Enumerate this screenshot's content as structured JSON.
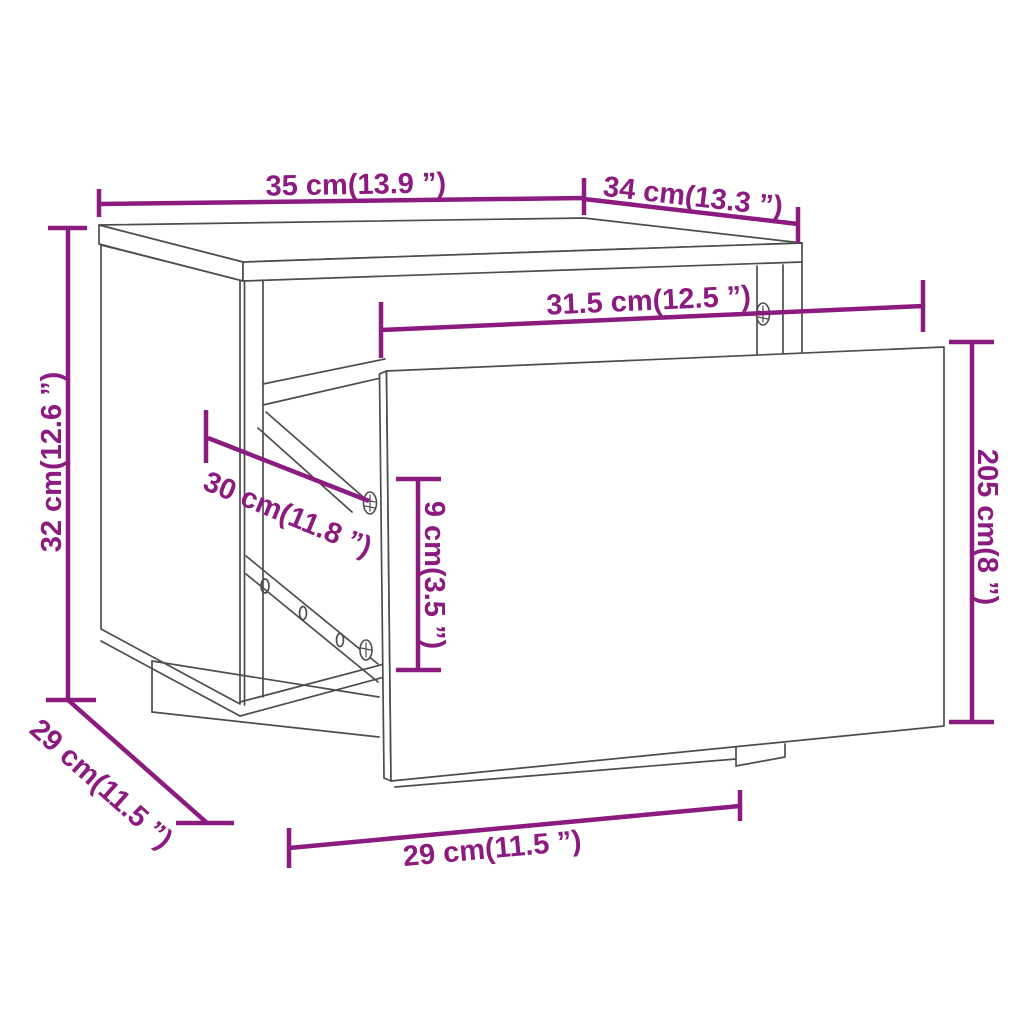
{
  "page": {
    "kind": "furniture-dimension-diagram",
    "product": "bedside cabinet with pulled-out drawer"
  },
  "style": {
    "dimension_color": "#8c1b80",
    "drawing_line_color": "#4d4d4d",
    "background": "#ffffff"
  },
  "dimensions": {
    "top_width": {
      "cm": 35,
      "in": 13.9,
      "label": "35 cm(13.9 ”)"
    },
    "top_depth": {
      "cm": 34,
      "in": 13.3,
      "label": "34 cm(13.3 ”)"
    },
    "interior_width": {
      "cm": 31.5,
      "in": 12.5,
      "label": "31.5 cm(12.5 ”)"
    },
    "overall_height": {
      "cm": 32,
      "in": 12.6,
      "label": "32 cm(12.6 ”)"
    },
    "slide_depth": {
      "cm": 30,
      "in": 11.8,
      "label": "30 cm(11.8 ”)"
    },
    "drawer_box_height": {
      "cm": 9,
      "in": 3.5,
      "label": "9 cm(3.5 ”)"
    },
    "drawer_front_height": {
      "cm": 205,
      "in": 8,
      "label": "205 cm(8 ”)"
    },
    "base_depth": {
      "cm": 29,
      "in": 11.5,
      "label": "29 cm(11.5 ”)"
    },
    "base_width": {
      "cm": 29,
      "in": 11.5,
      "label": "29 cm(11.5 ”)"
    }
  }
}
